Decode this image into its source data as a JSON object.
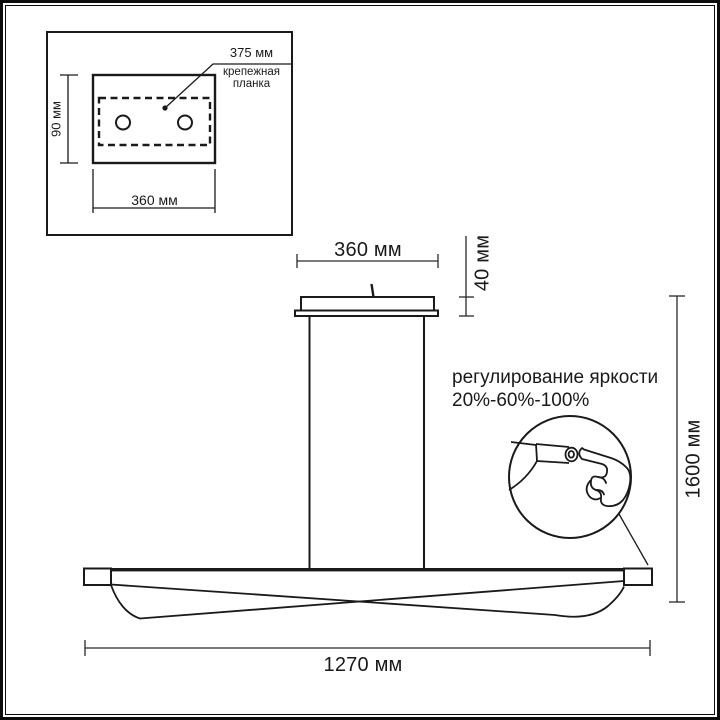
{
  "figure": {
    "kind": "pendant luminaire dimension drawing",
    "units": "мм",
    "colors": {
      "line": "#1a1a1a",
      "background": "#ffffff"
    }
  },
  "inset": {
    "callout_value": "375 мм",
    "callout_label": "крепежная планка",
    "height_dim": "90 мм",
    "width_dim": "360 мм"
  },
  "main": {
    "canopy_width_dim": "360 мм",
    "canopy_height_dim": "40 мм",
    "total_height_dim": "1600 мм",
    "body_width_dim": "1270 мм",
    "brightness_title": "регулирование яркости",
    "brightness_levels": "20%-60%-100%"
  }
}
